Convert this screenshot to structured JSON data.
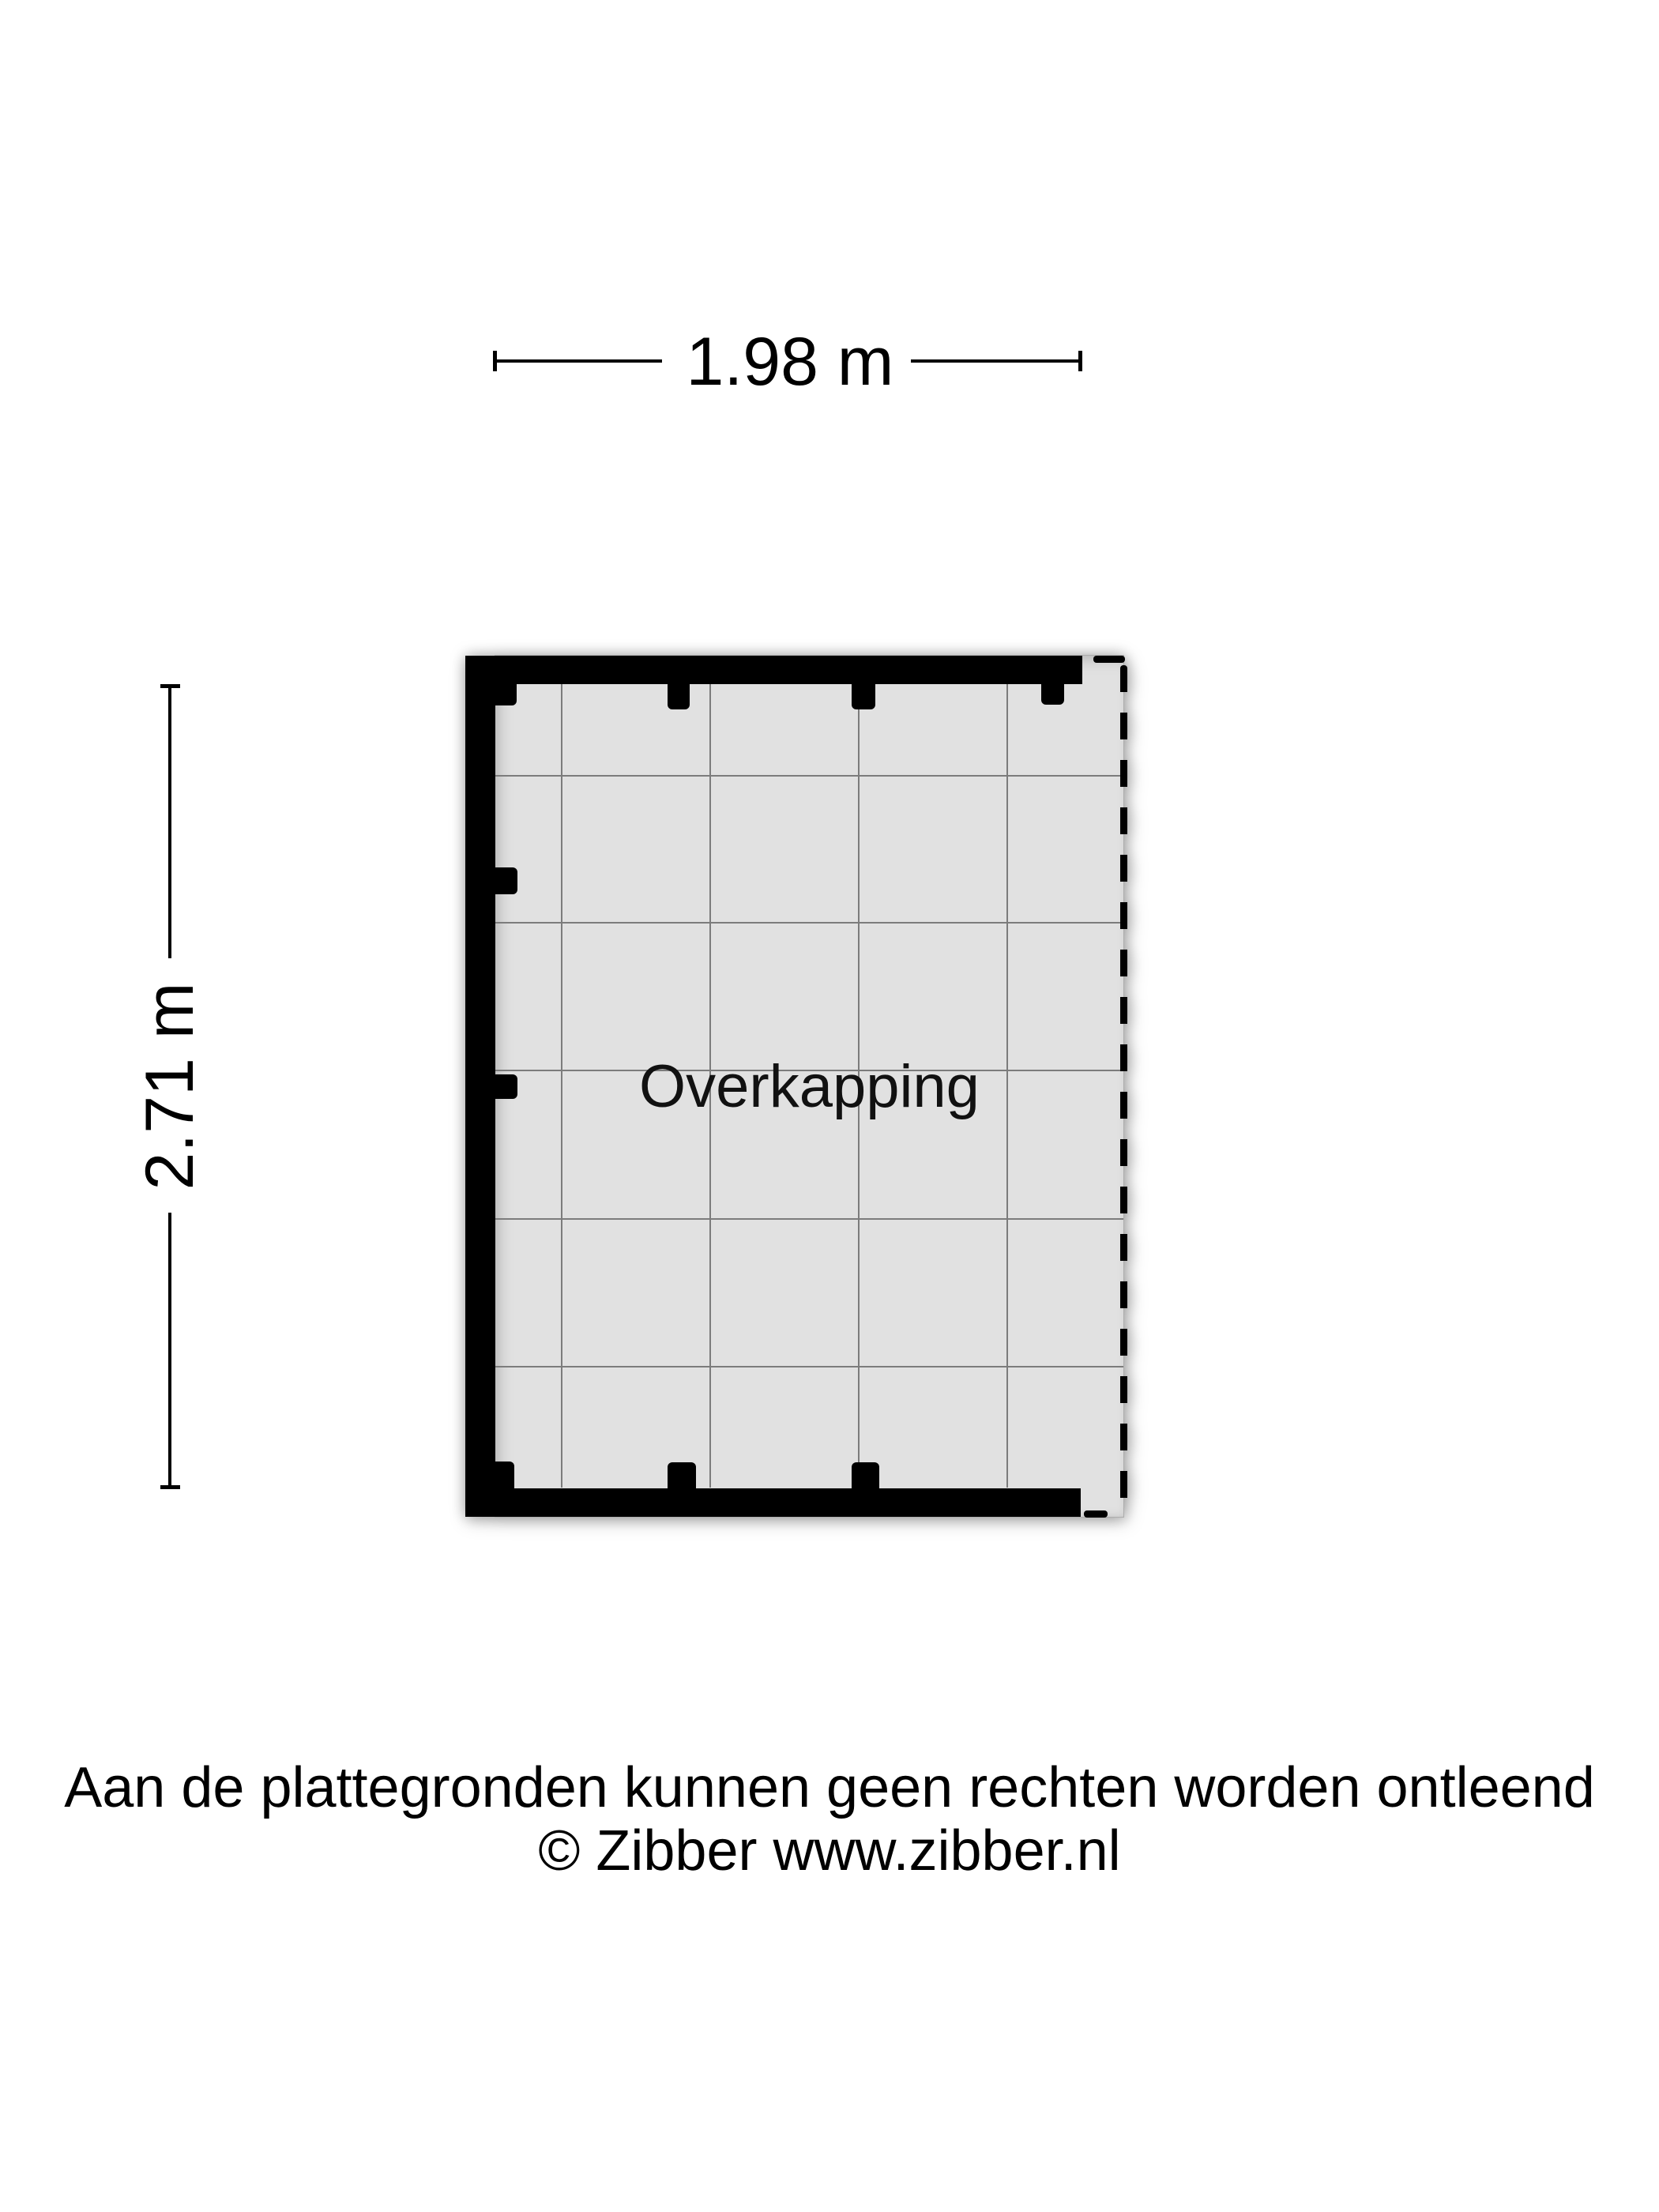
{
  "dimensions": {
    "width_label": "1.98 m",
    "height_label": "2.71 m"
  },
  "plan": {
    "room_label": "Overkapping"
  },
  "footer": {
    "disclaimer": "Aan de plattegronden kunnen geen rechten worden ontleend",
    "copyright": "© Zibber www.zibber.nl"
  },
  "colors": {
    "wall": "#000000",
    "floor": "#e1e1e1",
    "grid": "#7c7c7c",
    "text": "#000000",
    "background": "#ffffff"
  }
}
